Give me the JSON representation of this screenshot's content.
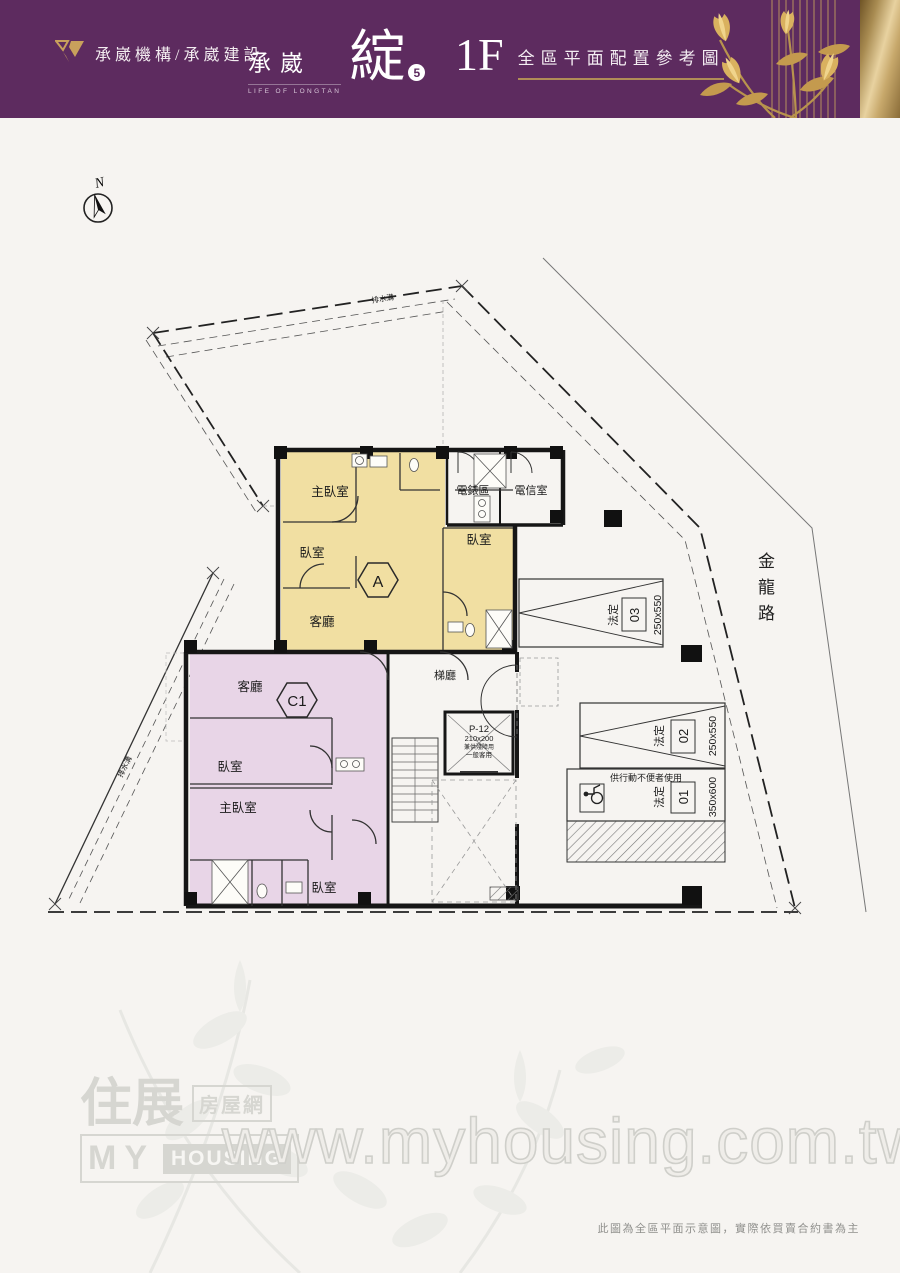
{
  "header": {
    "company": "承崴機構/承崴建設",
    "brand": {
      "name": "承崴",
      "tagline": "LIFE OF LONGTAN",
      "big": "綻",
      "phase": "5"
    },
    "floor_label": "1F",
    "page_title": "全區平面配置參考圖"
  },
  "plan": {
    "north": "N",
    "road": "金龍路",
    "drain": "排水溝",
    "unit_a": {
      "tag": "A",
      "master": "主臥室",
      "bed": "臥室",
      "living": "客廳",
      "bed2": "臥室"
    },
    "unit_c1": {
      "tag": "C1",
      "living": "客廳",
      "bed": "臥室",
      "master": "主臥室",
      "bed2": "臥室"
    },
    "service": {
      "meter": "電錶區",
      "telecom": "電信室"
    },
    "hall": "梯廳",
    "elevator": {
      "name": "P-12",
      "size": "210x200",
      "note1": "兼供殘障用",
      "note2": "一般客用"
    },
    "parking": [
      {
        "label": "法定",
        "no": "03",
        "size": "250x550"
      },
      {
        "label": "法定",
        "no": "02",
        "size": "250x550"
      },
      {
        "label": "法定",
        "no": "01",
        "size": "350x600",
        "note": "供行動不便者使用"
      }
    ]
  },
  "watermark": {
    "cn_top": "住展",
    "cn_box": "房屋網",
    "en_big": "MY",
    "en_box": "HOUSING",
    "url": "www.myhousing.com.tw"
  },
  "footer": {
    "disclaimer": "此圖為全區平面示意圖，實際依買賣合約書為主"
  },
  "colors": {
    "header_purple": "#5d2b5f",
    "gold": "#c9a260",
    "unit_a_fill": "#f1dfa2",
    "unit_c1_fill": "#e8d5e7"
  }
}
